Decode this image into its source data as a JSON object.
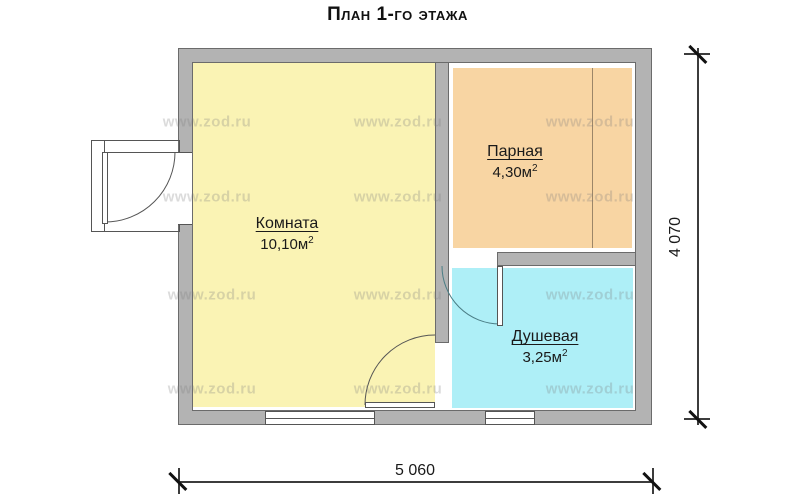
{
  "title": "План 1-го этажа",
  "rooms": [
    {
      "name": "Комната",
      "area": "10,10м",
      "sup": "2"
    },
    {
      "name": "Парная",
      "area": "4,30м",
      "sup": "2"
    },
    {
      "name": "Душевая",
      "area": "3,25м",
      "sup": "2"
    }
  ],
  "dimensions": {
    "height": "4 070",
    "width": "5 060"
  },
  "watermark": {
    "text": "www.zod.ru",
    "positions": [
      {
        "x": 207,
        "y": 122
      },
      {
        "x": 398,
        "y": 122
      },
      {
        "x": 590,
        "y": 122
      },
      {
        "x": 207,
        "y": 197
      },
      {
        "x": 398,
        "y": 197
      },
      {
        "x": 590,
        "y": 197
      },
      {
        "x": 212,
        "y": 295
      },
      {
        "x": 398,
        "y": 295
      },
      {
        "x": 590,
        "y": 295
      },
      {
        "x": 212,
        "y": 389
      },
      {
        "x": 398,
        "y": 389
      },
      {
        "x": 590,
        "y": 389
      }
    ]
  },
  "colors": {
    "wall": "#b3b3b3",
    "komnata": "#faf3b4",
    "parnaya": "#f8d5a3",
    "dushevaya": "#aeeff7",
    "line": "#555555"
  }
}
